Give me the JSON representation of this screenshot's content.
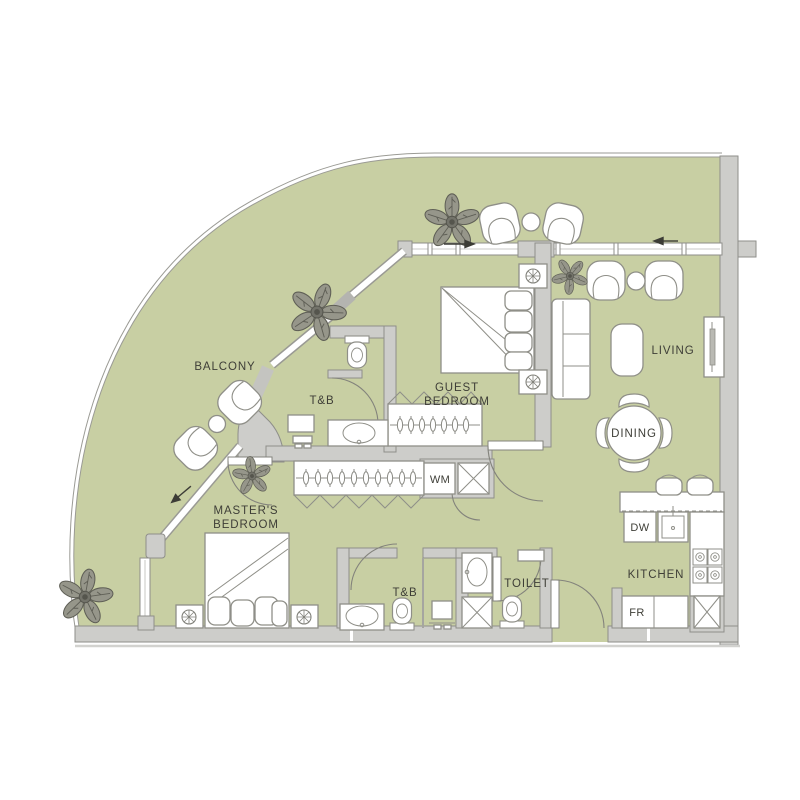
{
  "labels": {
    "balcony": "BALCONY",
    "guest_bedroom_line1": "GUEST",
    "guest_bedroom_line2": "BEDROOM",
    "masters_bedroom_line1": "MASTER'S",
    "masters_bedroom_line2": "BEDROOM",
    "living": "LIVING",
    "dining": "DINING",
    "kitchen": "KITCHEN",
    "toilet": "TOILET",
    "tb_guest": "T&B",
    "tb_master": "T&B",
    "washing_machine": "WM",
    "dishwasher": "DW",
    "refrigerator": "FR"
  },
  "colors": {
    "floor": "#c8cfa3",
    "wall_fill": "#cdcdca",
    "wall_stroke": "#8e8e8a",
    "furn_stroke": "#8f8f88",
    "label_text": "#3e3e37",
    "plant": "#5f5f56"
  }
}
